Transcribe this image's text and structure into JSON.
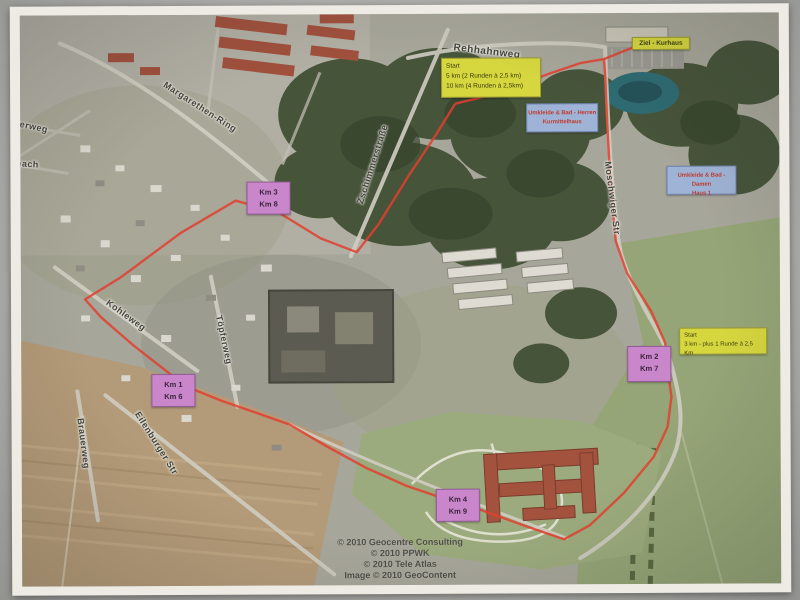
{
  "colors": {
    "route": "#e2402f",
    "marker_pink": "#ca86ca",
    "marker_yellow": "#d6d63f",
    "marker_blue": "#9fb3d6",
    "marker_blue_text": "#c0392b"
  },
  "annotations": {
    "start_main": {
      "title": "Start",
      "line1": "5 km (2 Runden à 2,5 km)",
      "line2": "10 km (4 Runden à 2,5km)"
    },
    "finish": {
      "label": "Ziel - Kurhaus"
    },
    "changing_men": {
      "line1": "Umkleide & Bad - Herren",
      "line2": "Kurmittelhaus"
    },
    "changing_women": {
      "line1": "Umkleide & Bad - Damen",
      "line2": "Haus 1"
    },
    "start_3km": {
      "title": "Start",
      "line1": "3 km - plus 1 Runde à 2,5 Km"
    },
    "km_markers": [
      {
        "line1": "Km 3",
        "line2": "Km 8"
      },
      {
        "line1": "Km 1",
        "line2": "Km 6"
      },
      {
        "line1": "Km 2",
        "line2": "Km 7"
      },
      {
        "line1": "Km 4",
        "line2": "Km 9"
      }
    ]
  },
  "street_labels": [
    {
      "text": "Rehhahnweg"
    },
    {
      "text": "Margarethen-Ring"
    },
    {
      "text": "Zschimmerstraße"
    },
    {
      "text": "Moschwiger Str"
    },
    {
      "text": "Kohleweg"
    },
    {
      "text": "Töpferweg"
    },
    {
      "text": "Brauerweg"
    },
    {
      "text": "Eilenburger Str"
    },
    {
      "text": "eberweg"
    },
    {
      "text": "hbach"
    }
  ],
  "credits": [
    "© 2010 Geocentre Consulting",
    "© 2010 PPWK",
    "© 2010 Tele Atlas",
    "Image © 2010 GeoContent"
  ]
}
